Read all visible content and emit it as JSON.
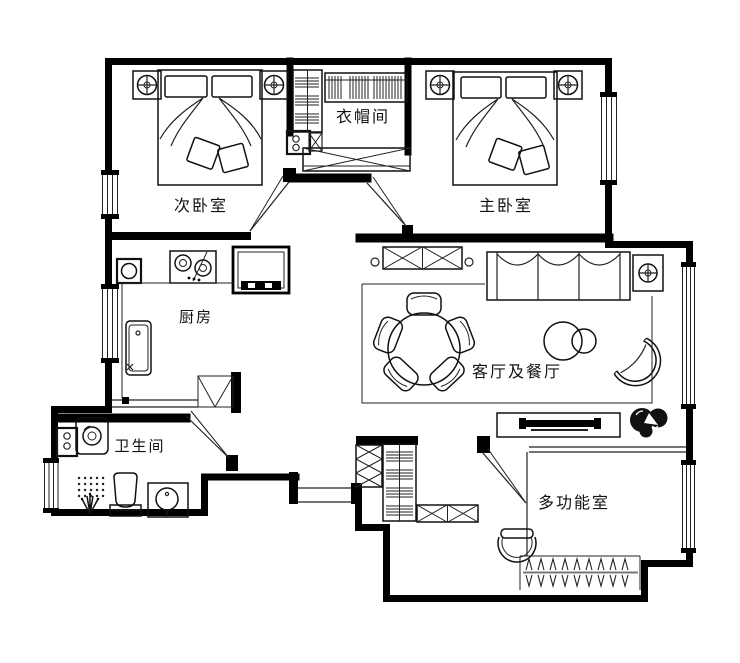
{
  "colors": {
    "wall": "#000000",
    "line": "#1a1a1a",
    "background": "#ffffff"
  },
  "rooms": [
    {
      "id": "secondary-bedroom",
      "label": "次卧室"
    },
    {
      "id": "cloakroom",
      "label": "衣帽间"
    },
    {
      "id": "master-bedroom",
      "label": "主卧室"
    },
    {
      "id": "kitchen",
      "label": "厨房"
    },
    {
      "id": "living-dining",
      "label": "客厅及餐厅"
    },
    {
      "id": "bathroom",
      "label": "卫生间"
    },
    {
      "id": "multi-function-room",
      "label": "多功能室"
    }
  ],
  "icons": {
    "ceiling-lamp-symbol": "⊕",
    "window-symbol": "parallel-lines",
    "door-symbol": "swing-wedge"
  }
}
